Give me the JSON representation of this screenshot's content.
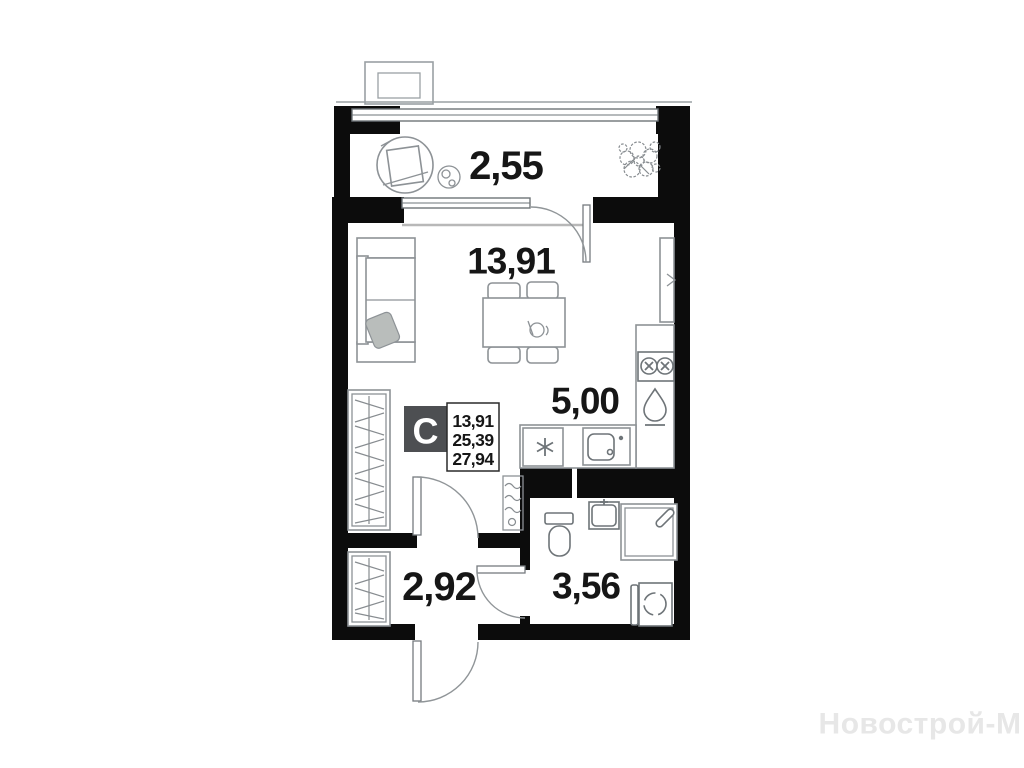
{
  "watermark": "Новострой-М",
  "legend": {
    "unit_type": "С",
    "living_area": "13,91",
    "area_without_balcony": "25,39",
    "total_area": "27,94"
  },
  "rooms": {
    "balcony": "2,55",
    "living_room": "13,91",
    "kitchen": "5,00",
    "hallway": "2,92",
    "bathroom": "3,56"
  },
  "colors": {
    "wall": "#0c0c0c",
    "furniture_stroke": "#8d9296",
    "legend_badge_bg": "#4d4f52",
    "label_text": "#161616",
    "watermark_text": "#e7e7e7"
  }
}
